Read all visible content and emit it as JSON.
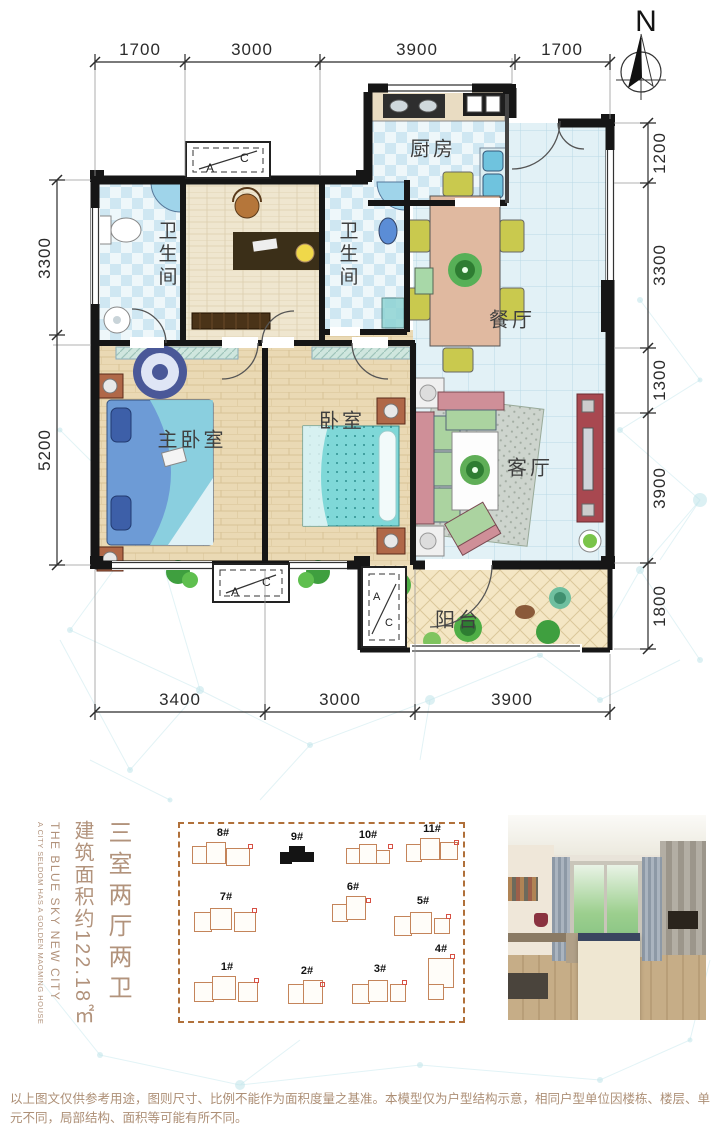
{
  "header": {
    "north_label": "N"
  },
  "floorplan": {
    "rooms": {
      "kitchen": "厨房",
      "bath1": "卫生间",
      "bath2": "卫生间",
      "dining": "餐厅",
      "master": "主卧室",
      "bedroom": "卧室",
      "living": "客厅",
      "balcony": "阳台"
    },
    "ac": {
      "a": "A",
      "c": "C"
    },
    "dims": {
      "top": [
        "1700",
        "3000",
        "3900",
        "1700"
      ],
      "bottom": [
        "3400",
        "3000",
        "3900"
      ],
      "left": [
        "3300",
        "5200"
      ],
      "right": [
        "1200",
        "3300",
        "1300",
        "3900",
        "1800"
      ]
    },
    "wall_color": "#161616"
  },
  "info": {
    "title": "三室两厅两卫",
    "area": "建筑面积约122.18㎡",
    "en_title": "THE BLUE SKY NEW CITY",
    "en_subtitle": "A CITY SELDOM HAS A GOLDEN MAOMING HOUSE",
    "accent_color": "#b2937c"
  },
  "siteplan": {
    "outline_color": "#b0703a",
    "highlighted": "9#",
    "buildings": [
      {
        "label": "1#"
      },
      {
        "label": "2#"
      },
      {
        "label": "3#"
      },
      {
        "label": "4#"
      },
      {
        "label": "5#"
      },
      {
        "label": "6#"
      },
      {
        "label": "7#"
      },
      {
        "label": "8#"
      },
      {
        "label": "9#"
      },
      {
        "label": "10#"
      },
      {
        "label": "11#"
      }
    ]
  },
  "footer": {
    "disclaimer": "以上图文仅供参考用途，图则尺寸、比例不能作为面积度量之基准。本模型仅为户型结构示意，相同户型单位因楼栋、楼层、单元不同，局部结构、面积等可能有所不同。"
  }
}
